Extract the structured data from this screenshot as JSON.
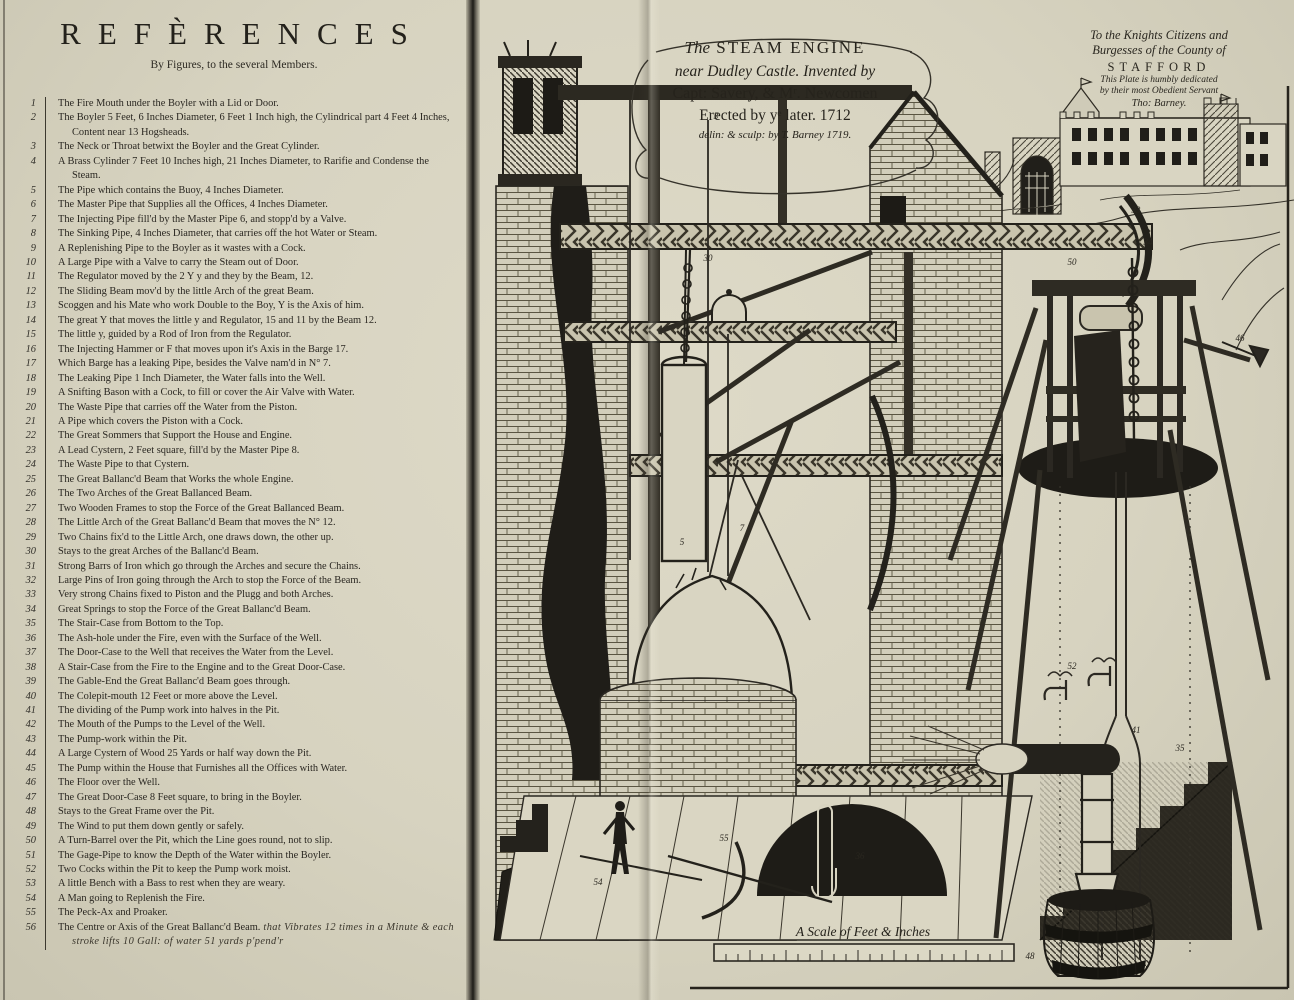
{
  "refs_page": {
    "title": "REFÈRENCES",
    "subtitle": "By Figures, to the several Members."
  },
  "references": [
    {
      "n": "1",
      "text": "The Fire Mouth under the Boyler with a Lid or Door."
    },
    {
      "n": "2",
      "text": "The Boyler 5 Feet, 6 Inches Diameter, 6 Feet 1 Inch high, the Cylindrical part 4 Feet 4 Inches, Content near 13 Hogsheads."
    },
    {
      "n": "3",
      "text": "The Neck or Throat betwixt the Boyler and the Great Cylinder."
    },
    {
      "n": "4",
      "text": "A Brass Cylinder 7 Feet 10 Inches high, 21 Inches Diameter, to Rarifie and Condense the Steam."
    },
    {
      "n": "5",
      "text": "The Pipe which contains the Buoy, 4 Inches Diameter."
    },
    {
      "n": "6",
      "text": "The Master Pipe that Supplies all the Offices, 4 Inches Diameter."
    },
    {
      "n": "7",
      "text": "The Injecting Pipe fill'd by the Master Pipe 6, and stopp'd by a Valve."
    },
    {
      "n": "8",
      "text": "The Sinking Pipe, 4 Inches Diameter, that carries off the hot Water or Steam."
    },
    {
      "n": "9",
      "text": "A Replenishing Pipe to the Boyler as it wastes with a Cock."
    },
    {
      "n": "10",
      "text": "A Large Pipe with a Valve to carry the Steam out of Door."
    },
    {
      "n": "11",
      "text": "The Regulator moved by the 2 Y y and they by the Beam, 12."
    },
    {
      "n": "12",
      "text": "The Sliding Beam mov'd by the little Arch of the great Beam."
    },
    {
      "n": "13",
      "text": "Scoggen and his Mate who work Double to the Boy, Y is the Axis of him."
    },
    {
      "n": "14",
      "text": "The great Y that moves the little y and Regulator, 15 and 11 by the Beam 12."
    },
    {
      "n": "15",
      "text": "The little y, guided by a Rod of Iron from the Regulator."
    },
    {
      "n": "16",
      "text": "The Injecting Hammer or F that moves upon it's Axis in the Barge 17."
    },
    {
      "n": "17",
      "text": "Which Barge has a leaking Pipe, besides the Valve nam'd in N° 7."
    },
    {
      "n": "18",
      "text": "The Leaking Pipe 1 Inch Diameter, the Water falls into the Well."
    },
    {
      "n": "19",
      "text": "A Snifting Bason with a Cock, to fill or cover the Air Valve with Water."
    },
    {
      "n": "20",
      "text": "The Waste Pipe that carries off the Water from the Piston."
    },
    {
      "n": "21",
      "text": "A Pipe which covers the Piston with a Cock."
    },
    {
      "n": "22",
      "text": "The Great Sommers that Support the House and Engine."
    },
    {
      "n": "23",
      "text": "A Lead Cystern, 2 Feet square, fill'd by the Master Pipe 8."
    },
    {
      "n": "24",
      "text": "The Waste Pipe to that Cystern."
    },
    {
      "n": "25",
      "text": "The Great Ballanc'd Beam that Works the whole Engine."
    },
    {
      "n": "26",
      "text": "The Two Arches of the Great Ballanced Beam."
    },
    {
      "n": "27",
      "text": "Two Wooden Frames to stop the Force of the Great Ballanced Beam."
    },
    {
      "n": "28",
      "text": "The Little Arch of the Great Ballanc'd Beam that moves the N° 12."
    },
    {
      "n": "29",
      "text": "Two Chains fix'd to the Little Arch, one draws down, the other up."
    },
    {
      "n": "30",
      "text": "Stays to the great Arches of the Ballanc'd Beam."
    },
    {
      "n": "31",
      "text": "Strong Barrs of Iron which go through the Arches and secure the Chains."
    },
    {
      "n": "32",
      "text": "Large Pins of Iron going through the Arch to stop the Force of the Beam."
    },
    {
      "n": "33",
      "text": "Very strong Chains fixed to Piston and the Plugg and both Arches."
    },
    {
      "n": "34",
      "text": "Great Springs to stop the Force of the Great Ballanc'd Beam."
    },
    {
      "n": "35",
      "text": "The Stair-Case from Bottom to the Top."
    },
    {
      "n": "36",
      "text": "The Ash-hole under the Fire, even with the Surface of the Well."
    },
    {
      "n": "37",
      "text": "The Door-Case to the Well that receives the Water from the Level."
    },
    {
      "n": "38",
      "text": "A Stair-Case from the Fire to the Engine and to the Great Door-Case."
    },
    {
      "n": "39",
      "text": "The Gable-End the Great Ballanc'd Beam goes through."
    },
    {
      "n": "40",
      "text": "The Colepit-mouth 12 Feet or more above the Level."
    },
    {
      "n": "41",
      "text": "The dividing of the Pump work into halves in the Pit."
    },
    {
      "n": "42",
      "text": "The Mouth of the Pumps to the Level of the Well."
    },
    {
      "n": "43",
      "text": "The Pump-work within the Pit."
    },
    {
      "n": "44",
      "text": "A Large Cystern of Wood 25 Yards or half way down the Pit."
    },
    {
      "n": "45",
      "text": "The Pump within the House that Furnishes all the Offices with Water."
    },
    {
      "n": "46",
      "text": "The Floor over the Well."
    },
    {
      "n": "47",
      "text": "The Great Door-Case 8 Feet square, to bring in the Boyler."
    },
    {
      "n": "48",
      "text": "Stays to the Great Frame over the Pit."
    },
    {
      "n": "49",
      "text": "The Wind to put them down gently or safely."
    },
    {
      "n": "50",
      "text": "A Turn-Barrel over the Pit, which the Line goes round, not to slip."
    },
    {
      "n": "51",
      "text": "The Gage-Pipe to know the Depth of the Water within the Boyler."
    },
    {
      "n": "52",
      "text": "Two Cocks within the Pit to keep the Pump work moist."
    },
    {
      "n": "53",
      "text": "A little Bench with a Bass to rest when they are weary."
    },
    {
      "n": "54",
      "text": "A Man going to Replenish the Fire."
    },
    {
      "n": "55",
      "text": "The Peck-Ax and Proaker."
    },
    {
      "n": "56",
      "text": "The Centre or Axis of the Great Ballanc'd Beam.",
      "note": "that Vibrates 12 times in a Minute & each stroke lifts 10 Gall: of water 51 yards p'pend'r"
    }
  ],
  "cartouche": {
    "line1_pre": "The",
    "line1": "STEAM ENGINE",
    "line2": "near Dudley Castle. Invented by",
    "line3": "Capt: Savery, & Mʳ. Newcomen",
    "line4": "Erected by yᵉ later. 1712",
    "line5": "delin: & sculp: by T. Barney 1719."
  },
  "dedication": {
    "line1": "To the Knights Citizens and",
    "line2": "Burgesses of the County of",
    "line3": "STAFFORD",
    "line4": "This Plate is humbly dedicated",
    "line5": "by their most Obedient Servant",
    "line6": "Tho: Barney."
  },
  "scale": {
    "label": "A Scale of Feet & Inches"
  },
  "plate": {
    "figure_labels": [
      {
        "t": "3",
        "x": 236,
        "y": 116
      },
      {
        "t": "30",
        "x": 228,
        "y": 258
      },
      {
        "t": "5",
        "x": 202,
        "y": 542
      },
      {
        "t": "7",
        "x": 262,
        "y": 528
      },
      {
        "t": "33",
        "x": 656,
        "y": 210
      },
      {
        "t": "34",
        "x": 668,
        "y": 242
      },
      {
        "t": "50",
        "x": 592,
        "y": 262
      },
      {
        "t": "46",
        "x": 760,
        "y": 338
      },
      {
        "t": "48",
        "x": 550,
        "y": 956
      },
      {
        "t": "52",
        "x": 592,
        "y": 666
      },
      {
        "t": "41",
        "x": 656,
        "y": 730
      },
      {
        "t": "35",
        "x": 700,
        "y": 748
      },
      {
        "t": "36",
        "x": 380,
        "y": 856
      },
      {
        "t": "54",
        "x": 118,
        "y": 882
      },
      {
        "t": "55",
        "x": 244,
        "y": 838
      }
    ],
    "ink": "#2b2822",
    "paper": "#d7d3c0"
  }
}
